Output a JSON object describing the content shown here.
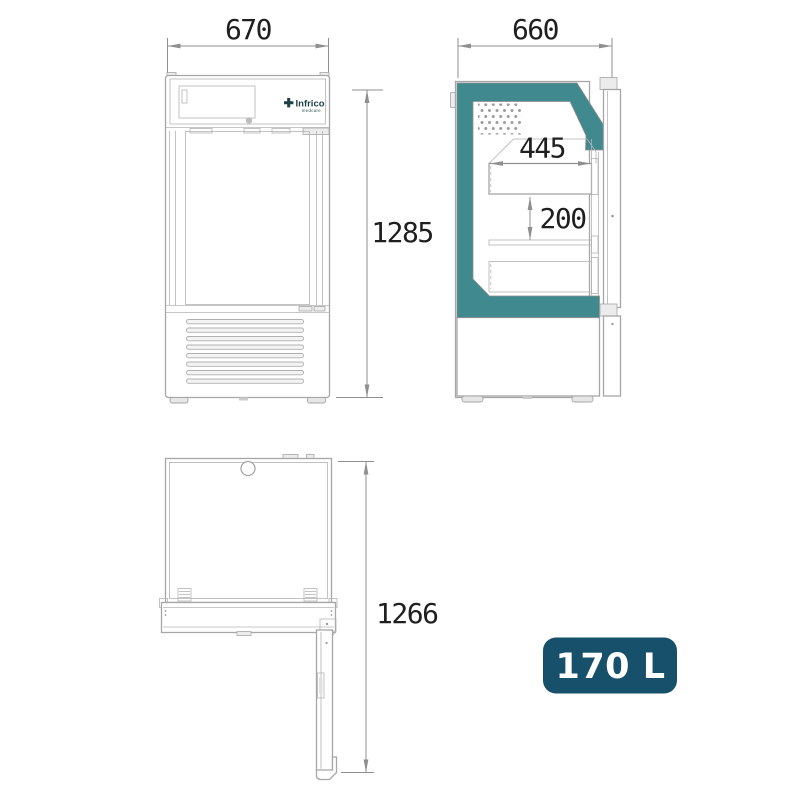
{
  "colors": {
    "teal_insulation": "#40898e",
    "badge_bg": "#17506b",
    "badge_text": "#ffffff",
    "line_gray": "#a6a6a6",
    "dimension_text": "#1f1f1f"
  },
  "brand": {
    "name": "Infrico",
    "tagline": "medcare"
  },
  "dimensions": {
    "front_width": "670",
    "front_height": "1285",
    "side_depth": "660",
    "shelf_width": "445",
    "shelf_spacing": "200",
    "depth_door_open": "1266"
  },
  "badge": {
    "capacity": "170 L"
  }
}
